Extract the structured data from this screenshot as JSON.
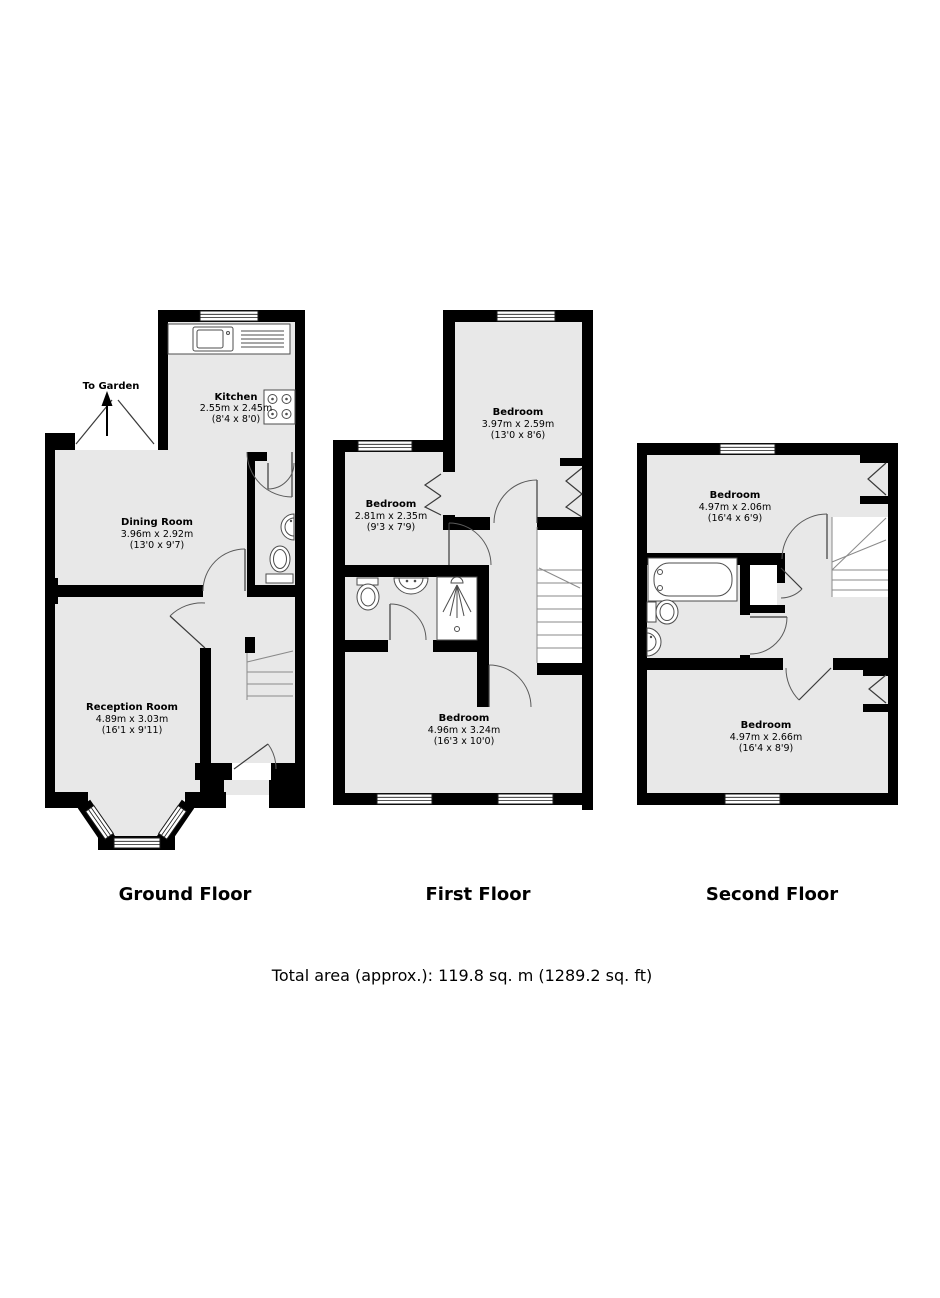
{
  "document_type": "property-floorplan",
  "floors": [
    {
      "label": "Ground Floor",
      "annotation": "To Garden",
      "rooms": [
        {
          "name": "Kitchen",
          "metric": "2.55m x 2.45m",
          "imperial": "(8'4 x 8'0)"
        },
        {
          "name": "Dining Room",
          "metric": "3.96m x 2.92m",
          "imperial": "(13'0 x 9'7)"
        },
        {
          "name": "Reception Room",
          "metric": "4.89m x 3.03m",
          "imperial": "(16'1 x 9'11)"
        }
      ]
    },
    {
      "label": "First Floor",
      "rooms": [
        {
          "name": "Bedroom",
          "metric": "3.97m x 2.59m",
          "imperial": "(13'0 x 8'6)"
        },
        {
          "name": "Bedroom",
          "metric": "2.81m x 2.35m",
          "imperial": "(9'3 x 7'9)"
        },
        {
          "name": "Bedroom",
          "metric": "4.96m x 3.24m",
          "imperial": "(16'3 x 10'0)"
        }
      ]
    },
    {
      "label": "Second Floor",
      "rooms": [
        {
          "name": "Bedroom",
          "metric": "4.97m x 2.06m",
          "imperial": "(16'4 x 6'9)"
        },
        {
          "name": "Bedroom",
          "metric": "4.97m x 2.66m",
          "imperial": "(16'4 x 8'9)"
        }
      ]
    }
  ],
  "footer": {
    "total_area": "Total area (approx.): 119.8 sq. m (1289.2 sq. ft)"
  },
  "colors": {
    "wall": "#000000",
    "floor_fill": "#e8e8e8",
    "fixture_stroke": "#4d4d4d"
  }
}
